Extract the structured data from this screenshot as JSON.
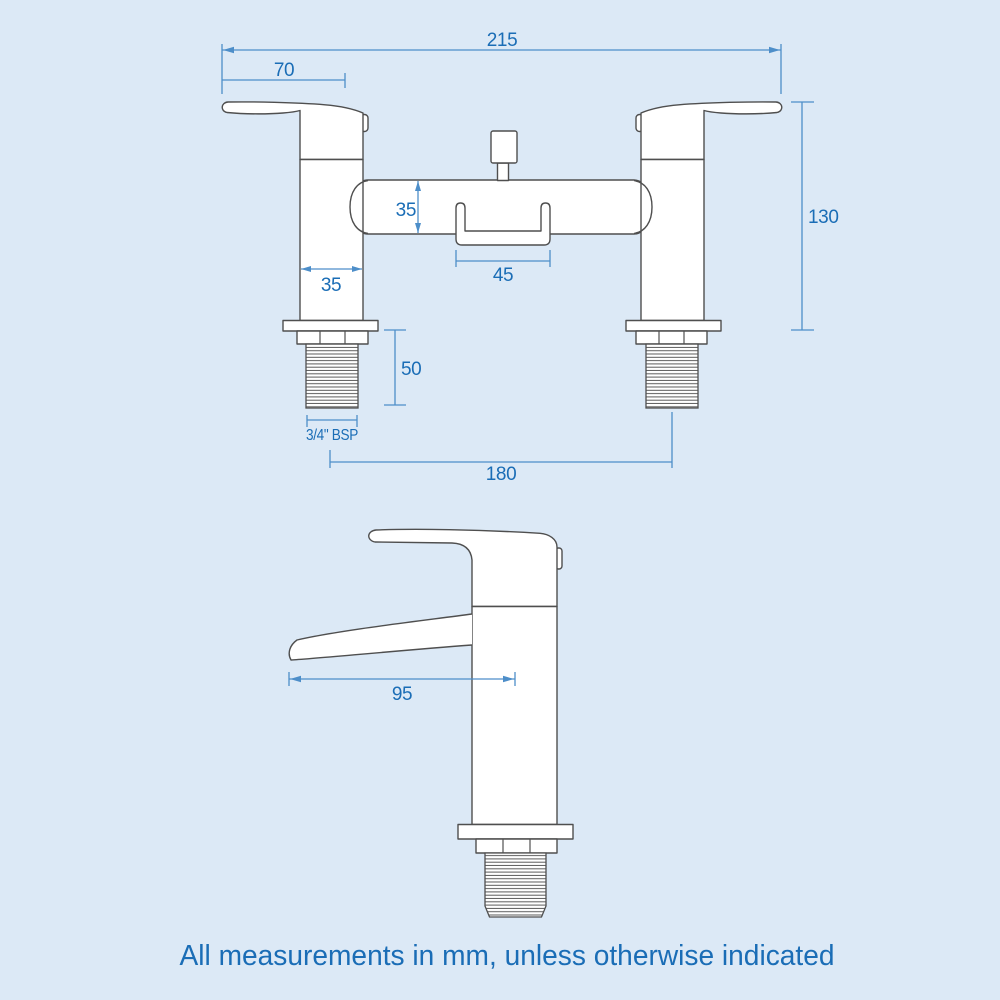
{
  "colors": {
    "background": "#dce9f6",
    "drawing_outline": "#4f4f4f",
    "drawing_fill": "#ffffff",
    "dimension_line": "#4d8ec9",
    "dimension_text": "#1a6db6"
  },
  "front_view": {
    "dimensions": {
      "overall_width": "215",
      "handle_length": "70",
      "overall_height": "130",
      "body_depth": "35",
      "pillar_width": "35",
      "diverter_width": "45",
      "tail_length": "50",
      "thread_size": "3/4\" BSP",
      "inlet_centres": "180"
    }
  },
  "side_view": {
    "dimensions": {
      "spout_reach": "95"
    }
  },
  "footer": {
    "note": "All measurements in mm, unless otherwise indicated"
  }
}
